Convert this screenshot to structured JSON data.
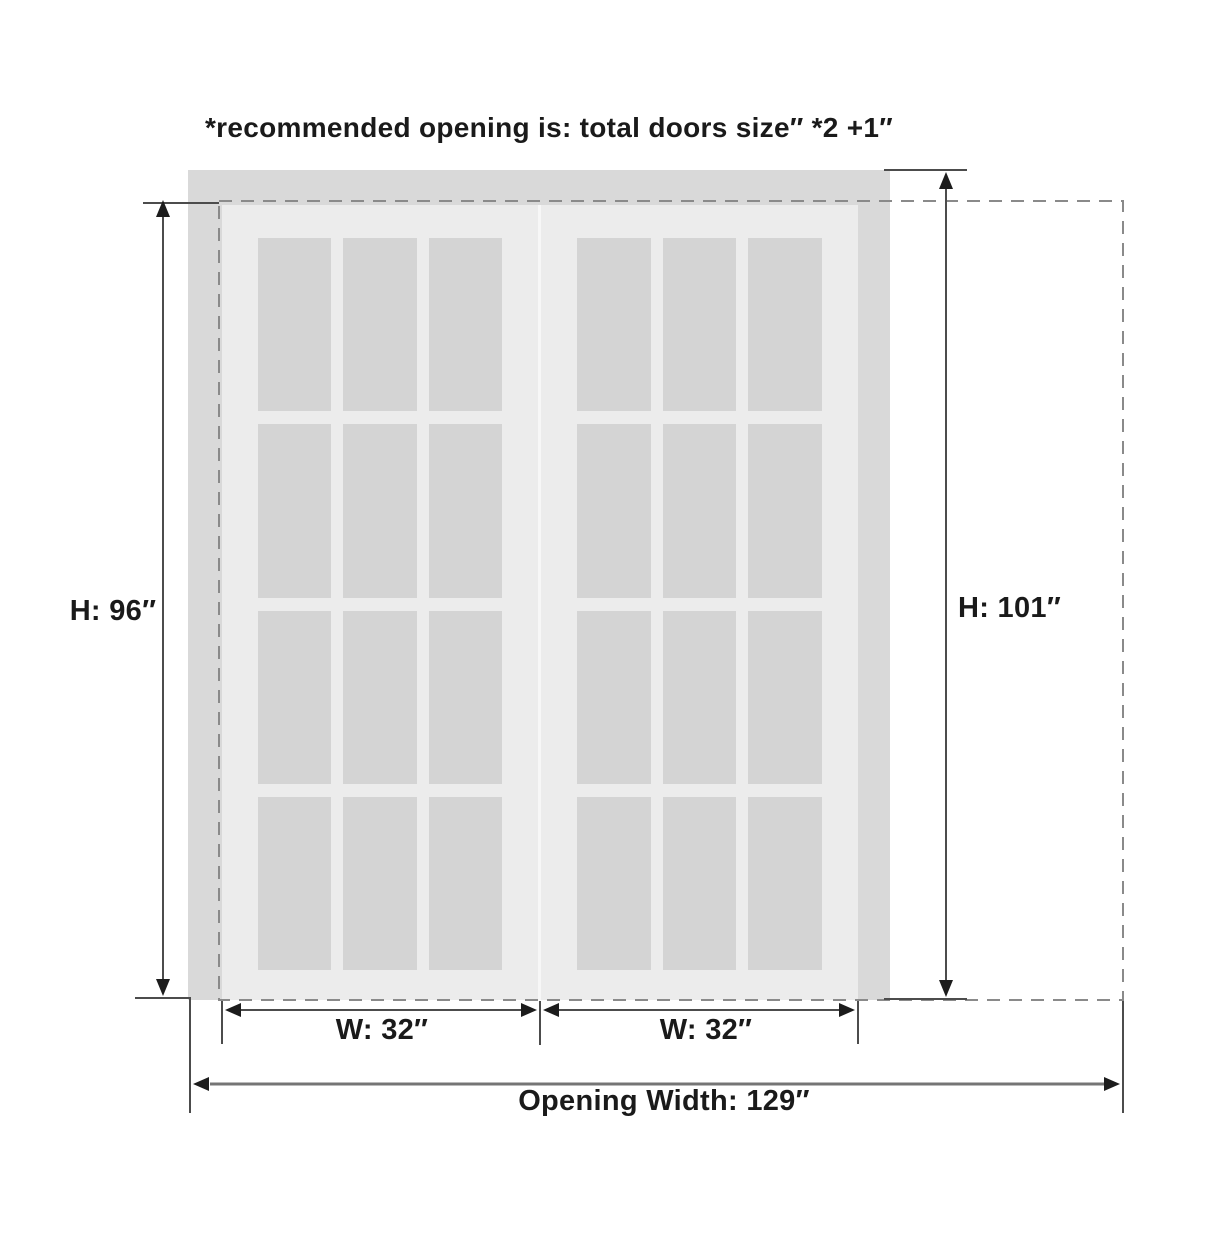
{
  "title": "*recommended opening is: total doors size″ *2 +1″",
  "labels": {
    "door_height": "H: 96″",
    "opening_height": "H: 101″",
    "left_door_width": "W: 32″",
    "right_door_width": "W: 32″",
    "opening_width": "Opening Width: 129″"
  },
  "dimensions": {
    "door_height_in": 96,
    "opening_height_in": 101,
    "left_door_width_in": 32,
    "right_door_width_in": 32,
    "opening_width_in": 129,
    "door_count": 2,
    "panes_per_door": {
      "columns": 3,
      "rows": 4
    }
  },
  "colors": {
    "background": "#ffffff",
    "frame_track": "#d9d9d9",
    "door_panel": "#ececec",
    "door_divider": "#f7f7f7",
    "glass_pane": "#d4d4d4",
    "dashed_outline": "#8a8a8a",
    "dimension_line": "#4c4c4c",
    "opening_width_line": "#757575",
    "arrowhead": "#1c1c1c",
    "text": "#1a1a1a"
  }
}
